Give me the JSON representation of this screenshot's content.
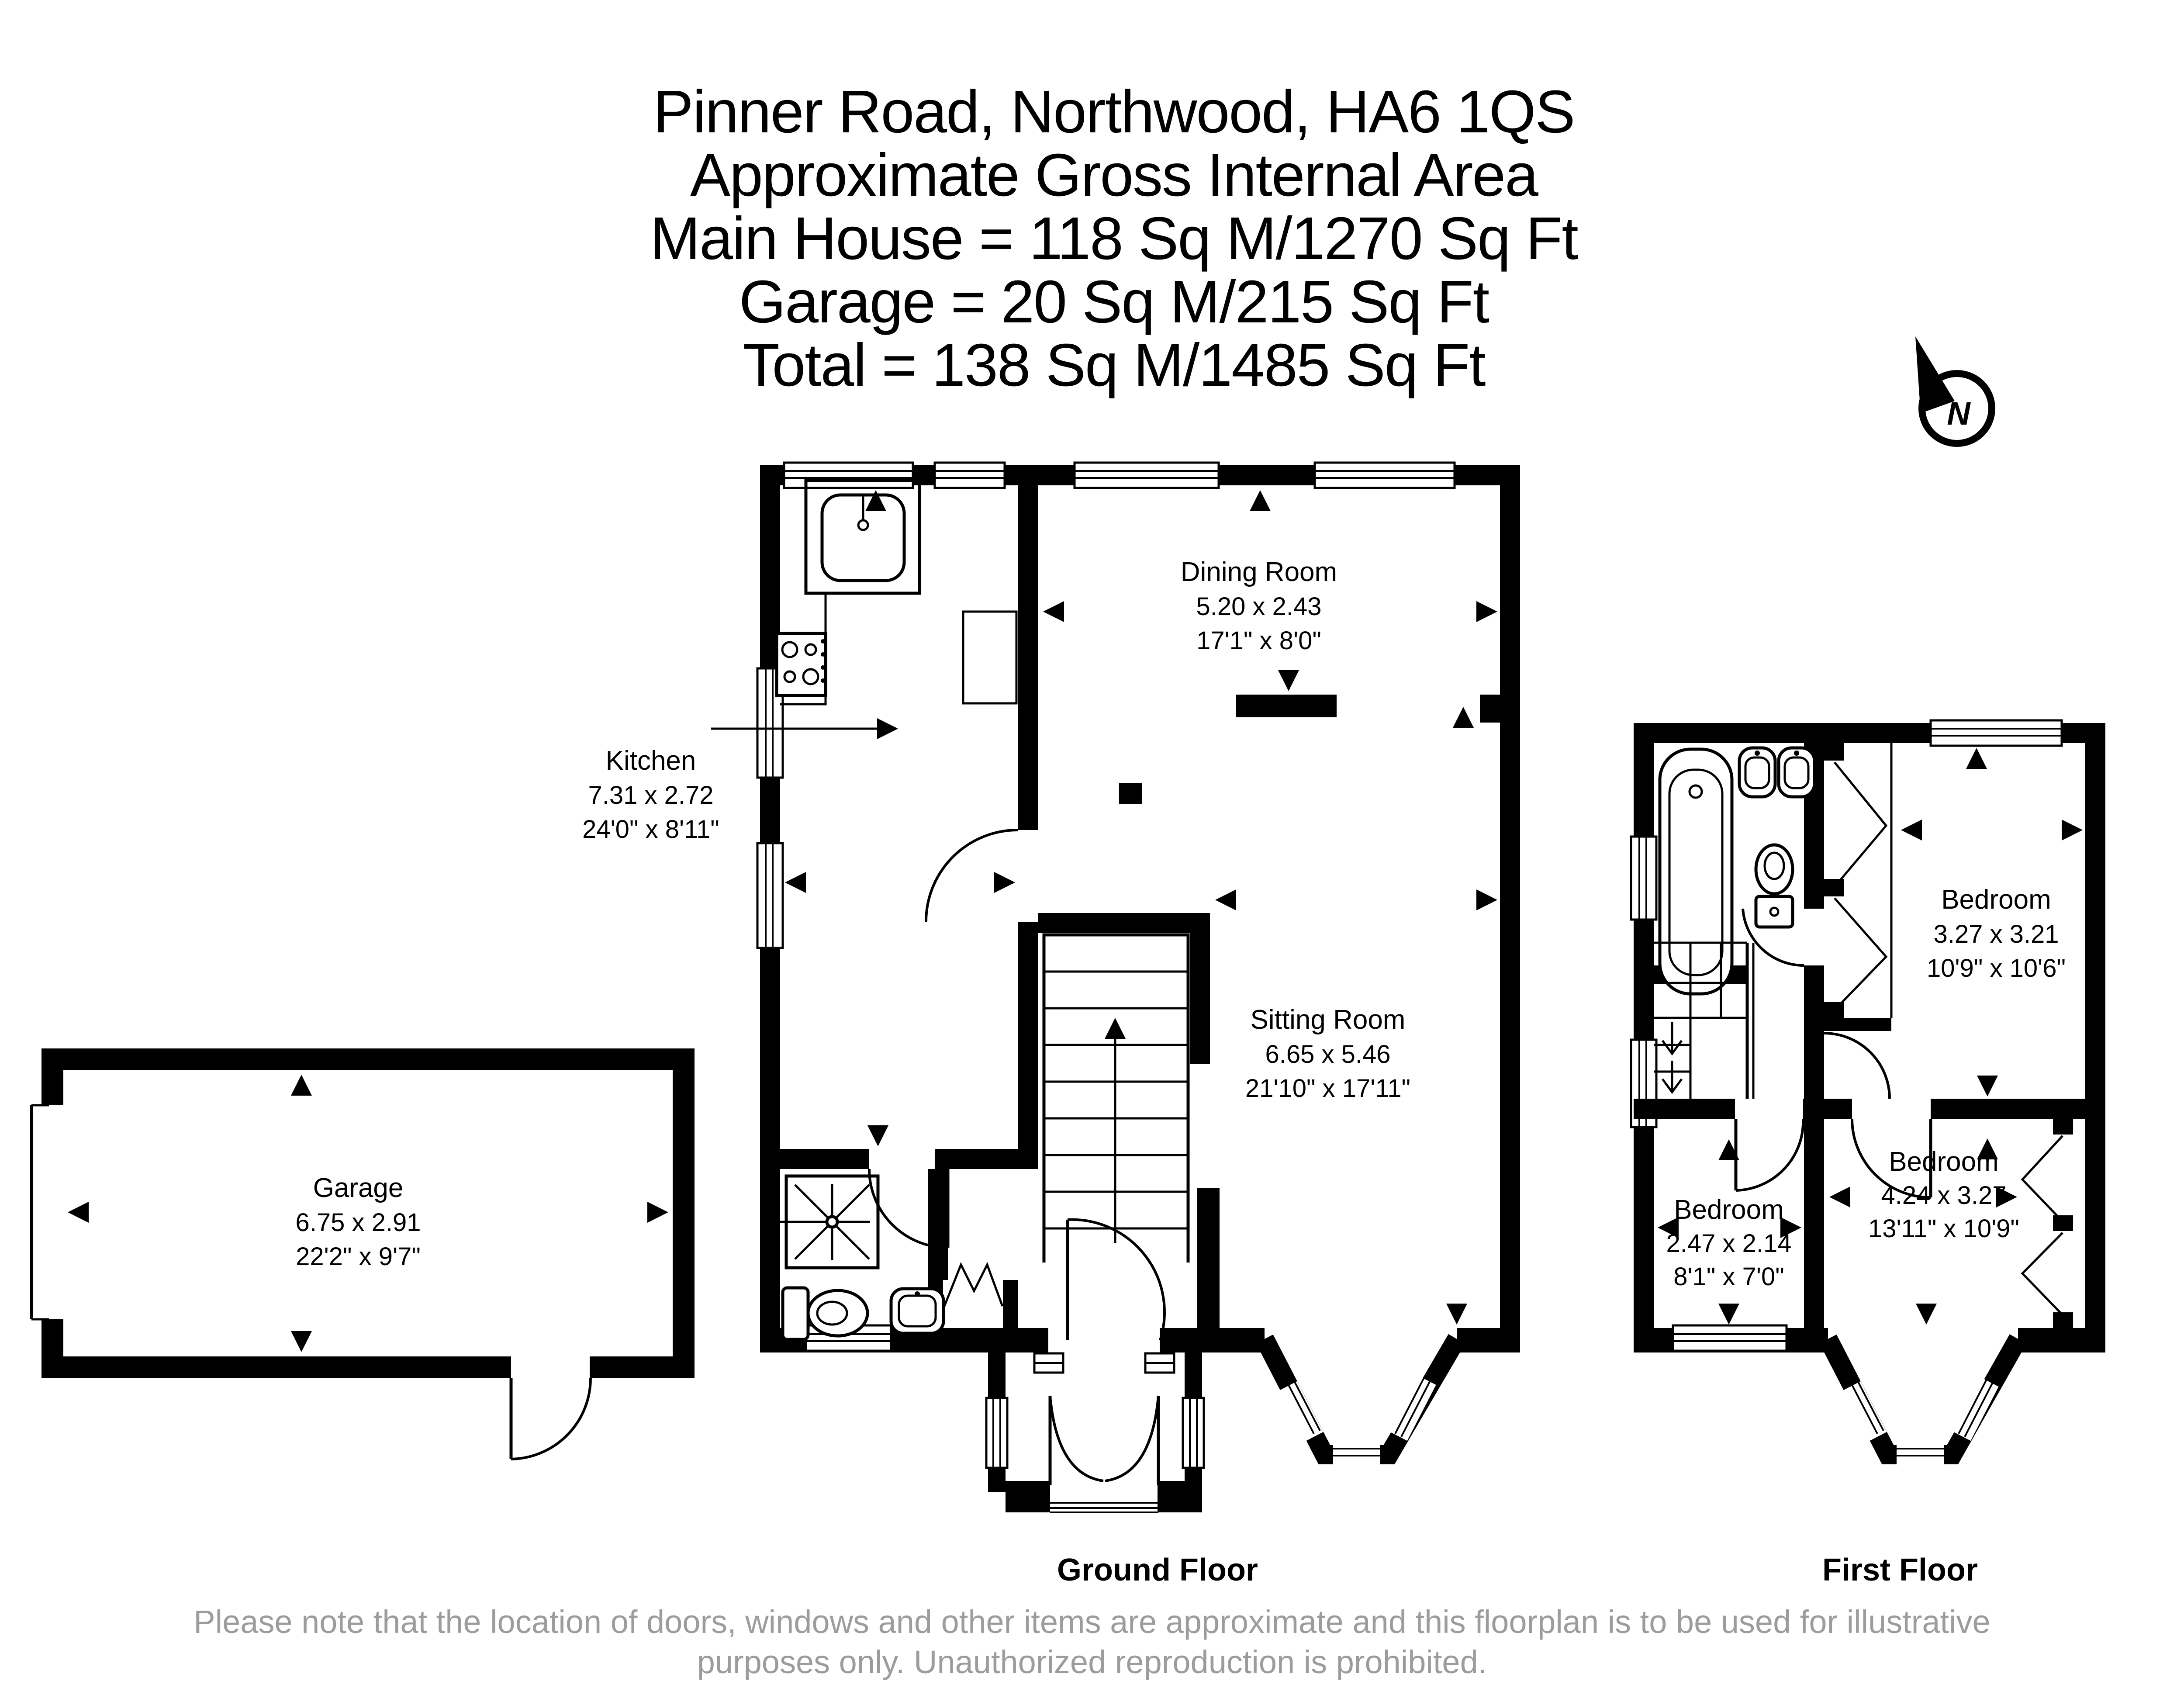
{
  "header": {
    "address": "Pinner Road, Northwood, HA6 1QS",
    "subtitle": "Approximate Gross Internal Area",
    "main_house": "Main House = 118 Sq M/1270 Sq Ft",
    "garage": "Garage = 20 Sq M/215 Sq Ft",
    "total": "Total = 138 Sq M/1485 Sq Ft"
  },
  "compass": {
    "label": "N"
  },
  "rooms": {
    "kitchen": {
      "name": "Kitchen",
      "metric": "7.31 x 2.72",
      "imperial": "24'0\" x 8'11\""
    },
    "dining_room": {
      "name": "Dining Room",
      "metric": "5.20 x 2.43",
      "imperial": "17'1\" x 8'0\""
    },
    "sitting_room": {
      "name": "Sitting Room",
      "metric": "6.65 x 5.46",
      "imperial": "21'10\" x 17'11\""
    },
    "garage": {
      "name": "Garage",
      "metric": "6.75 x 2.91",
      "imperial": "22'2\" x 9'7\""
    },
    "bedroom_front": {
      "name": "Bedroom",
      "metric": "3.27 x 3.21",
      "imperial": "10'9\" x 10'6\""
    },
    "bedroom_small": {
      "name": "Bedroom",
      "metric": "2.47 x 2.14",
      "imperial": "8'1\" x 7'0\""
    },
    "bedroom_rear": {
      "name": "Bedroom",
      "metric": "4.24 x 3.27",
      "imperial": "13'11\" x 10'9\""
    }
  },
  "floor_labels": {
    "ground": "Ground Floor",
    "first": "First Floor"
  },
  "disclaimer": {
    "line1": "Please note that the location of doors, windows and other items are approximate and this floorplan is to be used for illustrative",
    "line2": "purposes only. Unauthorized reproduction is prohibited."
  },
  "colors": {
    "wall": "#000000",
    "background": "#ffffff",
    "disclaimer_text": "#9a9c9e"
  }
}
